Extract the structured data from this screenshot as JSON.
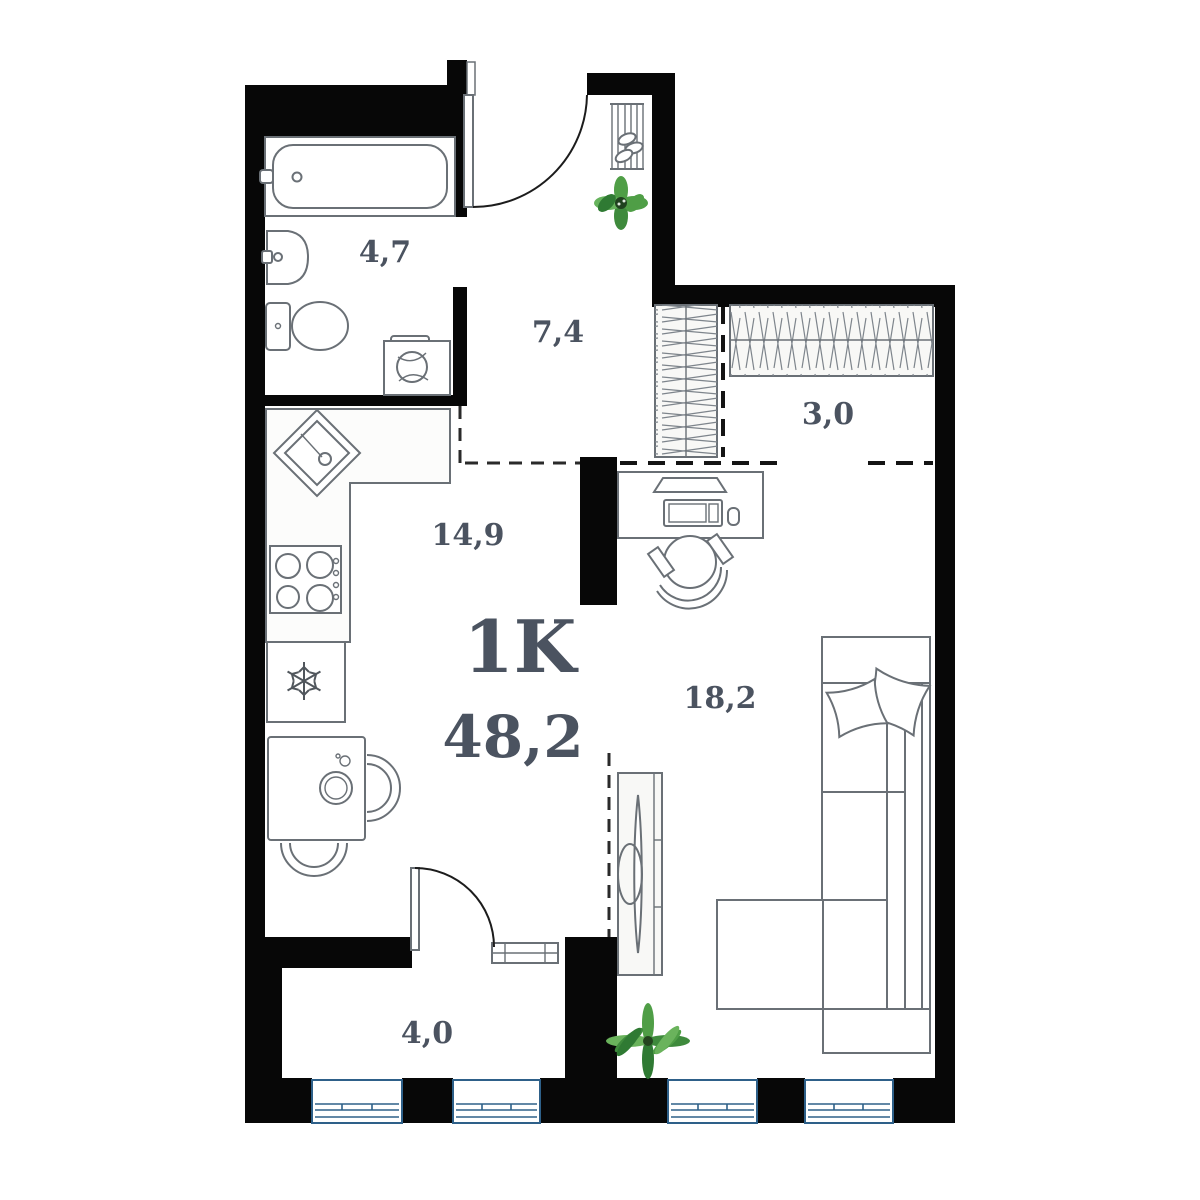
{
  "title": "1K",
  "total_area": "48,2",
  "rooms": {
    "bathroom": {
      "name": "bathroom",
      "area": "4,7"
    },
    "hallway": {
      "name": "hallway",
      "area": "7,4"
    },
    "wardrobe": {
      "name": "wardrobe",
      "area": "3,0"
    },
    "kitchen": {
      "name": "kitchen",
      "area": "14,9"
    },
    "living_room": {
      "name": "living room",
      "area": "18,2"
    },
    "balcony": {
      "name": "balcony",
      "area": "4,0"
    }
  },
  "colors": {
    "wall": "#070707",
    "furniture": "#6a7076",
    "text": "#4b5360",
    "window": "#2e6089",
    "plant_dark": "#2f7a33",
    "plant_light": "#6ab35c"
  }
}
